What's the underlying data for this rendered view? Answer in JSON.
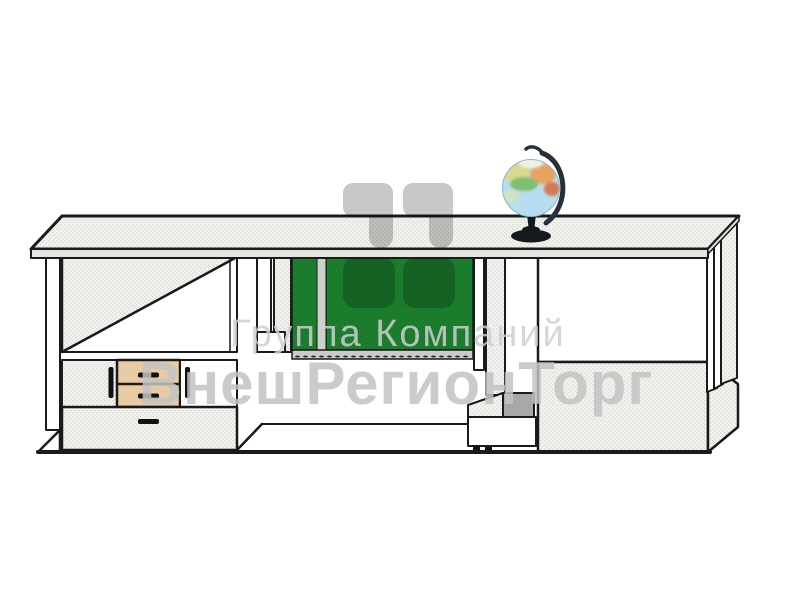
{
  "watermark": {
    "company_line": "Группа Компаний",
    "brand_line": "ВнешРегионТорг"
  },
  "objects": {
    "illustration": "demonstration-desk-line-drawing",
    "globe": "globe-illustration",
    "logo": "rounded-quote-marks-logo"
  },
  "colors": {
    "board_green": "#1b7f2e",
    "board_divider": "#ccd3c9",
    "chalk_tray": "#c8ccc5",
    "drawer_wood": "#e7cba4",
    "outline_dark": "#1a1a1a",
    "panel_light": "#f1f1ee",
    "step_gray": "#a8a8a8",
    "logo_gray": "#c8c8c8",
    "text_gray_light": "#d0d0d0",
    "text_gray_bold": "#c3c3c3",
    "globe_ocean": "#b6def0",
    "globe_stand": "#15181c"
  }
}
